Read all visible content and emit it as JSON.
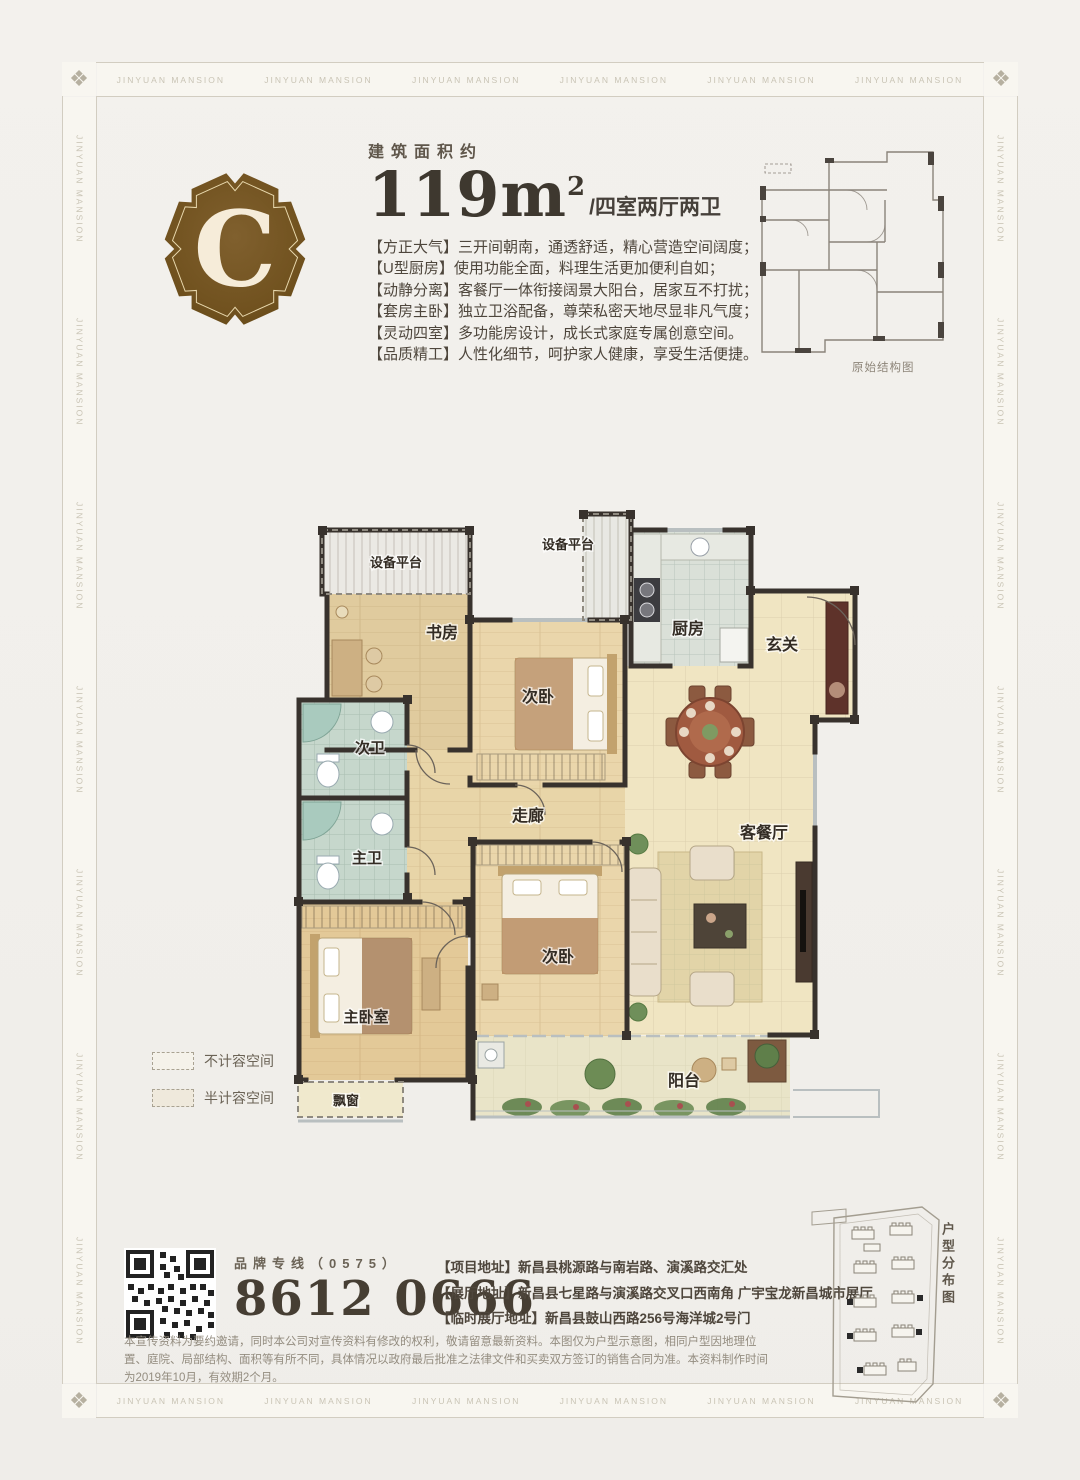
{
  "page": {
    "watermark": "JINYUAN MANSION",
    "corner_ornament": "❖"
  },
  "badge": {
    "letter": "C"
  },
  "header": {
    "area_label": "建筑面积约",
    "area_value": "119m",
    "area_sup": "2",
    "area_suffix": "/四室两厅两卫",
    "features": [
      "【方正大气】三开间朝南，通透舒适，精心营造空间阔度；",
      "【U型厨房】使用功能全面，料理生活更加便利自如；",
      "【动静分离】客餐厅一体衔接阔景大阳台，居家互不打扰；",
      "【套房主卧】独立卫浴配备，尊荣私密天地尽显非凡气度；",
      "【灵动四室】多功能房设计，成长式家庭专属创意空间。",
      "【品质精工】人性化细节，呵护家人健康，享受生活便捷。"
    ]
  },
  "mini_plan": {
    "caption": "原始结构图"
  },
  "floor_plan": {
    "rooms": {
      "equip_left": "设备平台",
      "equip_top": "设备平台",
      "study": "书房",
      "bedroom_top": "次卧",
      "kitchen": "厨房",
      "entry": "玄关",
      "bath_second": "次卫",
      "bath_master": "主卫",
      "corridor": "走廊",
      "living_dining": "客餐厅",
      "master_bedroom": "主卧室",
      "bedroom_bottom": "次卧",
      "balcony": "阳台",
      "bay_window": "飘窗"
    }
  },
  "legend": {
    "items": [
      {
        "label": "不计容空间"
      },
      {
        "label": "半计容空间"
      }
    ]
  },
  "contact": {
    "hotline_label": "品牌专线（0575）",
    "phone": "8612 0666",
    "addresses": [
      "【项目地址】新昌县桃源路与南岩路、演溪路交汇处",
      "【展厅地址】新昌县七星路与演溪路交叉口西南角 广宇宝龙新昌城市展厅",
      "【临时展厅地址】新昌县鼓山西路256号海洋城2号门"
    ],
    "site_plan_caption": "户型分布图"
  },
  "disclaimer": "本宣传资料为要约邀请，同时本公司对宣传资料有修改的权利，敬请留意最新资料。本图仅为户型示意图，相同户型因地理位置、庭院、局部结构、面积等有所不同，具体情况以政府最后批准之法律文件和买卖双方签订的销售合同为准。本资料制作时间为2019年10月，有效期2个月。",
  "colors": {
    "paper": "#f2f0ec",
    "badge_brown": "#74552a",
    "badge_text": "#f6ecd9",
    "ink": "#453d32",
    "wall": "#38322d",
    "wood_floor": "#e8d5a8",
    "bath_tile": "#c6d7cc",
    "living_floor": "#f0e5c2",
    "balcony_green": "#5f7f4a"
  }
}
